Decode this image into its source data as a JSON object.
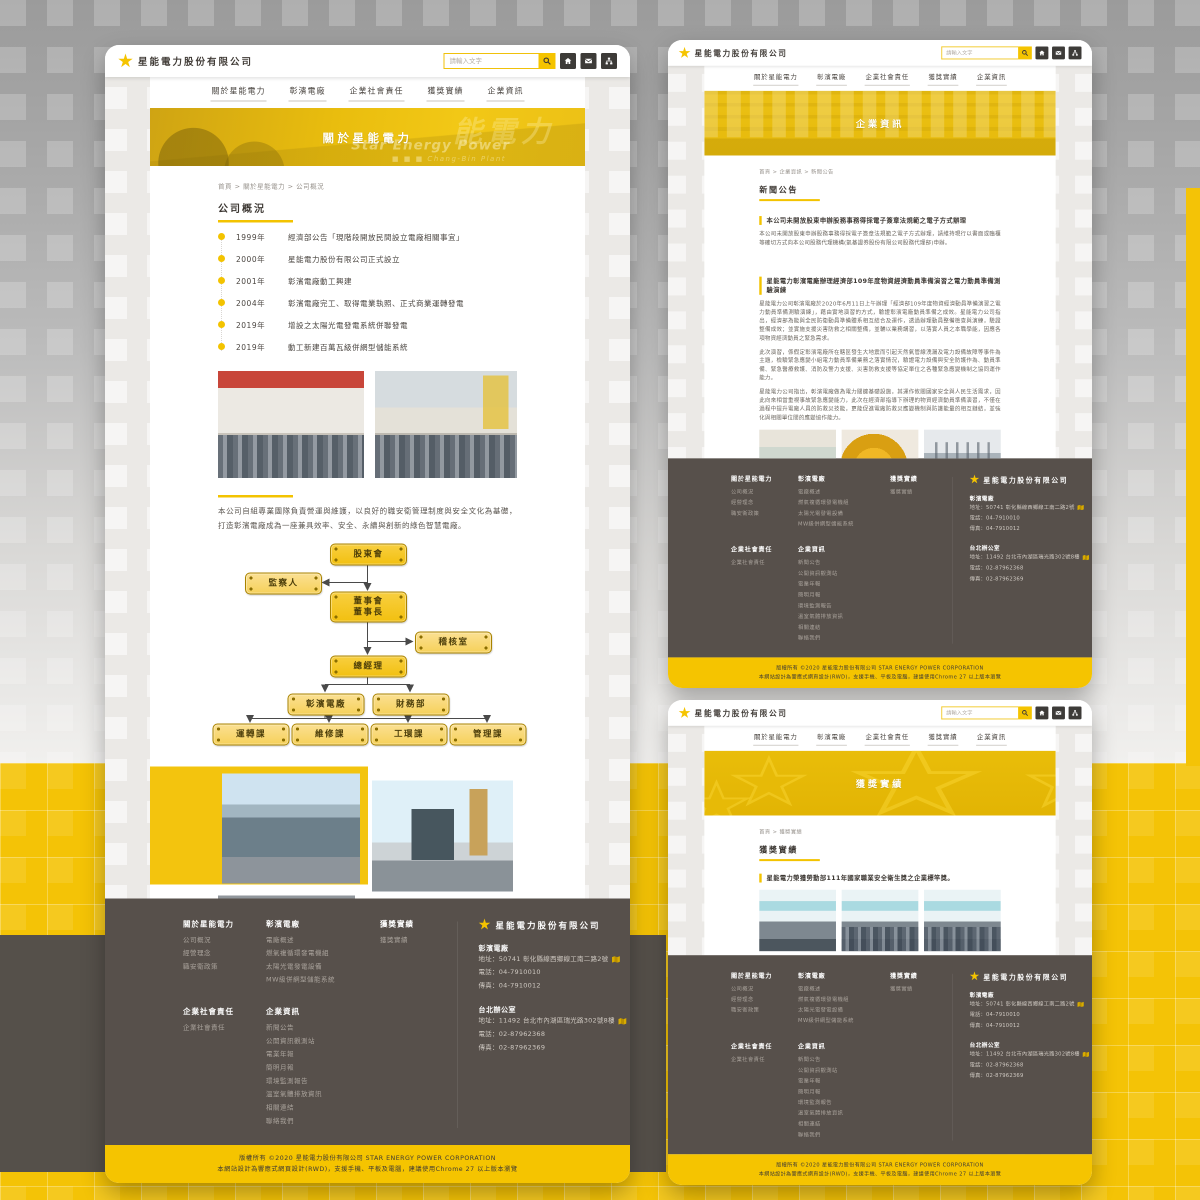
{
  "company": {
    "name": "星能電力股份有限公司",
    "name_en": "STAR ENERGY POWER CORPORATION"
  },
  "header": {
    "search_placeholder": "請輸入文字",
    "nav_labels": [
      "關於星能電力",
      "彰濱電廠",
      "企業社會責任",
      "獲獎實績",
      "企業資訊"
    ],
    "icons": {
      "search": "magnifier",
      "home": "house",
      "mail": "envelope",
      "sitemap": "org-tree"
    }
  },
  "colors": {
    "accent": "#f3c300",
    "footer_bg": "#57504b",
    "banner_yellow": "#e9bd0e",
    "canvas_yellow": "#f4c306",
    "dark_band": "#55504a"
  },
  "about_page": {
    "banner_title": "關於星能電力",
    "banner_overlay_zh": "能電力",
    "banner_overlay_en": "Star Energy Power",
    "banner_overlay_en2": "■ ■ ■  Chang-Bin Plant",
    "breadcrumb": "首頁 > 關於星能電力 > 公司概況",
    "section_title": "公司概況",
    "timeline": [
      {
        "year": "1999年",
        "text": "經濟部公告「現階段開放民間設立電廠相關事宜」"
      },
      {
        "year": "2000年",
        "text": "星能電力股份有限公司正式設立"
      },
      {
        "year": "2001年",
        "text": "彰濱電廠動工興建"
      },
      {
        "year": "2004年",
        "text": "彰濱電廠完工、取得電業執照、正式商業運轉發電"
      },
      {
        "year": "2019年",
        "text": "增設之太陽光電發電系統併聯發電"
      },
      {
        "year": "2019年",
        "text": "動工新建百萬瓦級併網型儲能系統"
      }
    ],
    "paragraph": "本公司自組專業團隊負責營運與維護，以良好的職安衛管理制度與安全文化為基礎，打造彰濱電廠成為一座兼具效率、安全、永續與創新的綠色智慧電廠。",
    "org_chart": {
      "shareholders": "股東會",
      "supervisor": "監察人",
      "board_line1": "董事會",
      "board_line2": "董事長",
      "audit": "稽核室",
      "gm": "總經理",
      "plant": "彰濱電廠",
      "finance": "財務部",
      "sections": [
        "運轉課",
        "維修課",
        "工環課",
        "管理課"
      ]
    }
  },
  "news_page": {
    "banner_title": "企業資訊",
    "breadcrumb": "首頁 > 企業資訊 > 新聞公告",
    "section_title": "新聞公告",
    "item1": {
      "title": "本公司未開放股東申辦股務事務得採電子簽章法規範之電子方式辦理",
      "paragraphs": [
        "本公司未開放股東申辦股務事務得採電子簽章法規範之電子方式辦理，請維持現行以書面或臨櫃等確切方式向本公司股務代理機構(凱基證券股份有限公司股務代理部)申辦。"
      ]
    },
    "item2": {
      "title": "星能電力彰濱電廠辦理經濟部109年度物資經濟動員準備演習之電力動員準備測驗演練",
      "paragraphs": [
        "星能電力公司彰濱電廠於2020年6月11日上午辦理「經濟部109年度物資經濟動員準備演習之電力動員準備測驗演練」，藉由實地演習的方式，驗證彰濱電廠動員準備之成效。星能電力公司指出，經濟部為能與全民防衛動員準備體系相互結合及運作，透過辦理動員整備檢查與演練，驗證整備成效；並實施支援災害防救之相關整備，並輔以業務講習，以落實人員之本職學能，因應各項物資經濟動員之緊急需求。",
        "此次演習，係假定彰濱電廠所在轄區發生大地震而引起天然氣管線洩漏及電力設備故障等事件為主題，檢驗緊急應變小組電力動員準備業務之落實情況，驗證電力設備與安全防護作為、動員準備、緊急醫療救護、消防及警力支援、災害防救支援等協定單位之各種緊急應變機制之協同運作能力。",
        "星能電力公司指出，彰濱電廠做為電力關鍵基礎設施，其運作攸關國家安全與人民生活需求，因此向來相當重視事故緊急應變能力，此次在經濟部指導下辦理的物資經濟動員準備演習，不僅在過程中提升電廠人員的防救災技能，更能促進電廠防救災應變機制與防護能量的相互鏈結，並強化與相關單位間的應變協作能力。"
      ]
    }
  },
  "awards_page": {
    "banner_title": "獲獎實績",
    "breadcrumb": "首頁 > 獲獎實績",
    "section_title": "獲獎實績",
    "item1_title": "星能電力榮獲勞動部111年國家職業安全衛生獎之企業標竿獎。",
    "item2_title": "星能電力榮獲勞動部108年國家職業安全衛生獎之中小企業安全衛生特別獎。"
  },
  "footer": {
    "columns": [
      {
        "title": "關於星能電力",
        "links": [
          "公司概況",
          "經營理念",
          "職安衛政策"
        ]
      },
      {
        "title": "彰濱電廠",
        "links": [
          "電廠概述",
          "燃氣複循環發電機組",
          "太陽光電發電設備",
          "MW級併網型儲能系統"
        ]
      },
      {
        "title": "獲獎實績",
        "links": [
          "獲獎實績"
        ]
      },
      {
        "title": "企業社會責任",
        "links": [
          "企業社會責任"
        ]
      },
      {
        "title": "企業資訊",
        "links": [
          "新聞公告",
          "公開資訊觀測站",
          "電業年報",
          "簡明月報",
          "環境監測報告",
          "溫室氣體排放資訊",
          "相關連結",
          "聯絡我們"
        ]
      }
    ],
    "contact": {
      "company": "星能電力股份有限公司",
      "plant_title": "彰濱電廠",
      "plant_address": "地址：50741 彰化縣線西鄉線工南二路2號",
      "plant_tel": "電話：04-7910010",
      "plant_fax": "傳真：04-7910012",
      "office_title": "台北辦公室",
      "office_address": "地址：11492 台北市內湖區瑞光路302號8樓",
      "office_tel": "電話：02-87962368",
      "office_fax": "傳真：02-87962369"
    },
    "copyright_line1": "版權所有 ©2020 星能電力股份有限公司 STAR ENERGY POWER CORPORATION",
    "copyright_line2": "本網站設計為響應式網頁設計(RWD)，支援手機、平板及電腦，建議使用Chrome 27 以上版本瀏覽"
  }
}
